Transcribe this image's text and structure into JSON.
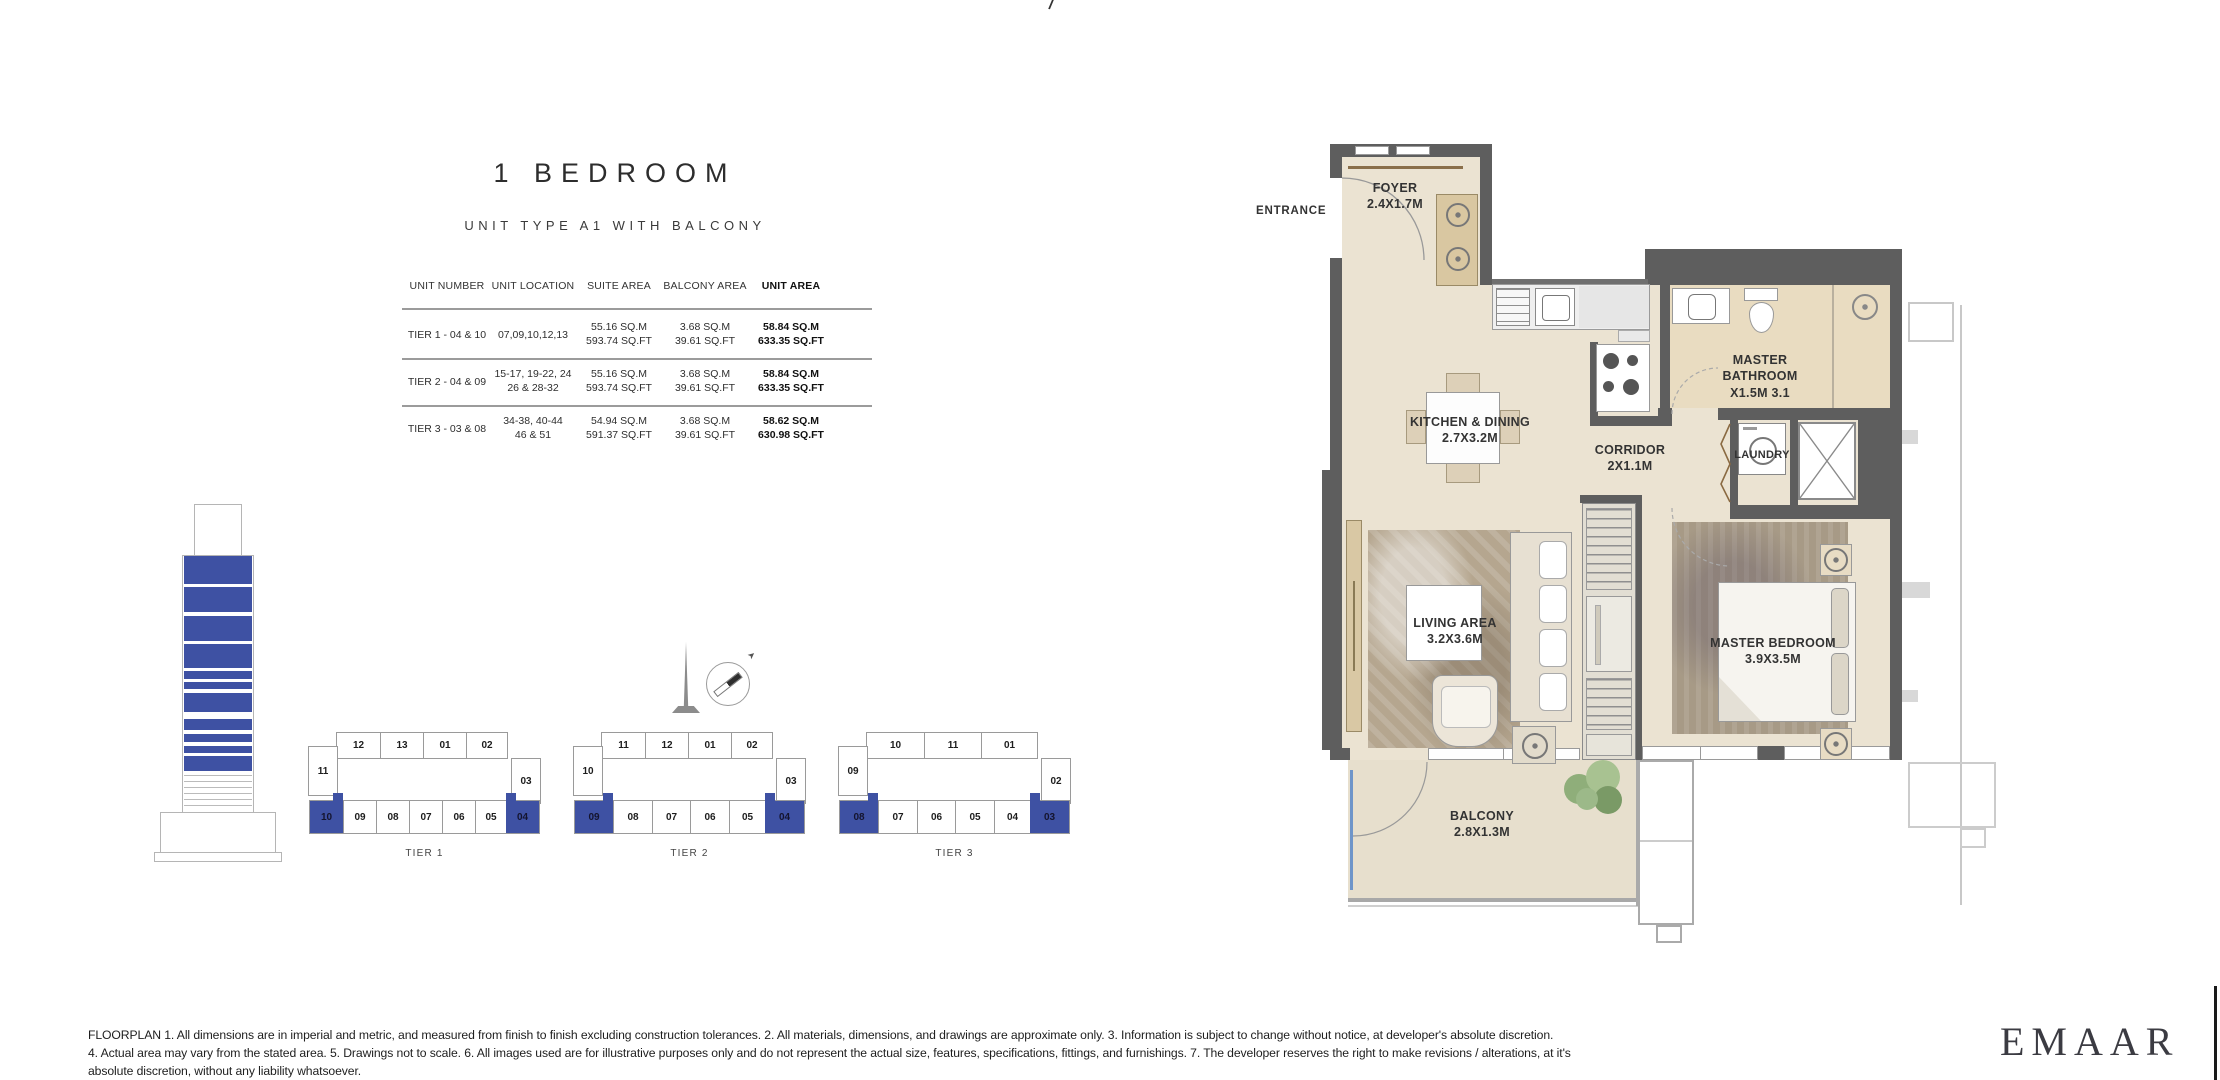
{
  "meta": {
    "top_mark": "/"
  },
  "header": {
    "title": "1 BEDROOM",
    "subtitle": "UNIT TYPE A1 WITH BALCONY"
  },
  "table": {
    "headers": [
      "UNIT NUMBER",
      "UNIT LOCATION",
      "SUITE AREA",
      "BALCONY AREA",
      "UNIT AREA"
    ],
    "rows": [
      {
        "unit_number": "TIER 1 - 04 & 10",
        "location1": "07,09,10,12,13",
        "location2": "",
        "suite1": "55.16 SQ.M",
        "suite2": "593.74 SQ.FT",
        "balcony1": "3.68 SQ.M",
        "balcony2": "39.61 SQ.FT",
        "unit1": "58.84 SQ.M",
        "unit2": "633.35 SQ.FT"
      },
      {
        "unit_number": "TIER 2 - 04 & 09",
        "location1": "15-17, 19-22, 24",
        "location2": "26 & 28-32",
        "suite1": "55.16 SQ.M",
        "suite2": "593.74 SQ.FT",
        "balcony1": "3.68 SQ.M",
        "balcony2": "39.61 SQ.FT",
        "unit1": "58.84 SQ.M",
        "unit2": "633.35 SQ.FT"
      },
      {
        "unit_number": "TIER 3 - 03 & 08",
        "location1": "34-38, 40-44",
        "location2": "46 & 51",
        "suite1": "54.94 SQ.M",
        "suite2": "591.37 SQ.FT",
        "balcony1": "3.68 SQ.M",
        "balcony2": "39.61 SQ.FT",
        "unit1": "58.62 SQ.M",
        "unit2": "630.98 SQ.FT"
      }
    ]
  },
  "tiers": [
    {
      "label": "TIER 1",
      "top": [
        "12",
        "13",
        "01",
        "02"
      ],
      "left": "11",
      "right": "03",
      "bottom": [
        "10",
        "09",
        "08",
        "07",
        "06",
        "05",
        "04"
      ]
    },
    {
      "label": "TIER 2",
      "top": [
        "11",
        "12",
        "01",
        "02"
      ],
      "left": "10",
      "right": "03",
      "bottom": [
        "09",
        "08",
        "07",
        "06",
        "05",
        "04"
      ]
    },
    {
      "label": "TIER 3",
      "top": [
        "10",
        "11",
        "01"
      ],
      "left": "09",
      "right": "02",
      "bottom": [
        "08",
        "07",
        "06",
        "05",
        "04",
        "03"
      ]
    }
  ],
  "floorplan": {
    "entrance": "ENTRANCE",
    "rooms": {
      "foyer": {
        "name": "FOYER",
        "dims": "2.4X1.7M"
      },
      "kitchen": {
        "name": "KITCHEN & DINING",
        "dims": "2.7X3.2M"
      },
      "bathroom": {
        "name1": "MASTER",
        "name2": "BATHROOM",
        "dims": "X1.5M 3.1"
      },
      "corridor": {
        "name": "CORRIDOR",
        "dims": "2X1.1M"
      },
      "laundry": {
        "name": "LAUNDRY"
      },
      "living": {
        "name": "LIVING AREA",
        "dims": "3.2X3.6M"
      },
      "bedroom": {
        "name": "MASTER BEDROOM",
        "dims": "3.9X3.5M"
      },
      "balcony": {
        "name": "BALCONY",
        "dims": "2.8X1.3M"
      }
    }
  },
  "footer": {
    "line1": "FLOORPLAN 1. All dimensions are in imperial and metric, and measured from finish to finish excluding construction tolerances. 2. All materials, dimensions, and drawings are approximate only. 3. Information is subject to change without notice, at developer's absolute discretion.",
    "line2": "4. Actual area may vary from the stated area. 5. Drawings not to scale. 6. All images used are for illustrative purposes only and do not represent the actual size, features, specifications, fittings, and furnishings. 7. The developer reserves the right to make revisions / alterations, at it's",
    "line3": "absolute discretion, without any liability whatsoever.",
    "brand": "EMAAR"
  },
  "colors": {
    "highlight": "#3e51a3",
    "wall": "#5e5e5e",
    "floor": "#ebe3d2"
  }
}
